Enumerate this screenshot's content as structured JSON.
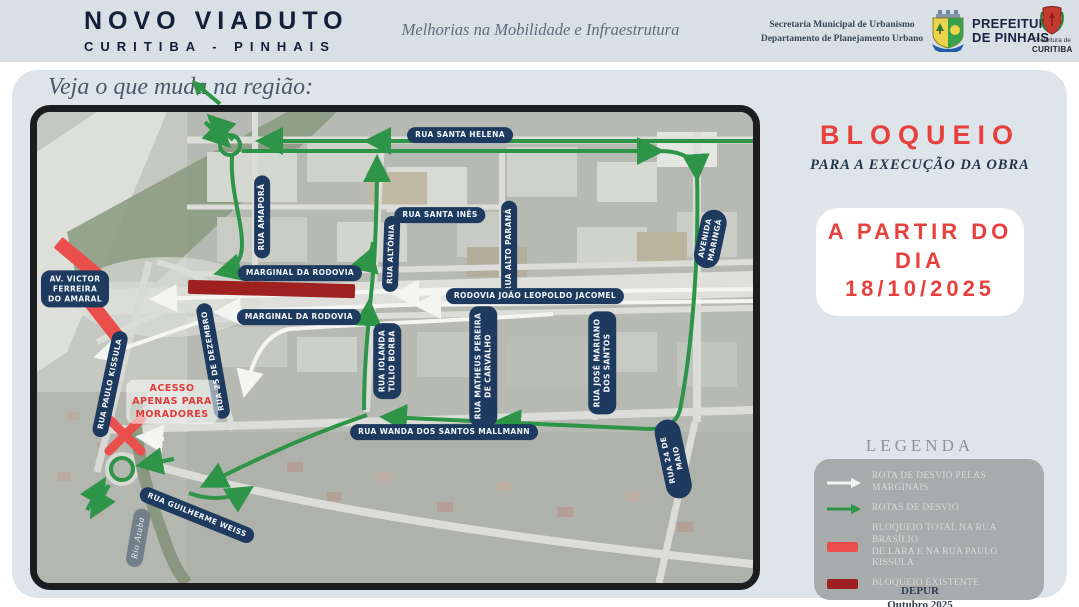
{
  "header": {
    "title_line1": "NOVO VIADUTO",
    "title_line2": "CURITIBA - PINHAIS",
    "tagline": "Melhorias na Mobilidade e Infraestrutura",
    "secretariat_line1": "Secretaria Municipal de Urbanismo",
    "secretariat_line2": "Departamento de Planejamento Urbano",
    "pinhais_logo_label": "PREFEITURA\nDE PINHAIS",
    "curitiba_logo_label_top": "Prefeitura de",
    "curitiba_logo_label_bottom": "CURITIBA"
  },
  "intro_title": "Veja o que muda na região:",
  "map": {
    "labels": [
      {
        "text": "RUA SANTA HELENA"
      },
      {
        "text": "RUA AMAPORÃ"
      },
      {
        "text": "RUA SANTA INÊS"
      },
      {
        "text": "RUA ALTÔNIA"
      },
      {
        "text": "RUA ALTO PARANÁ"
      },
      {
        "text": "AVENIDA MARINGÁ"
      },
      {
        "text": "MARGINAL DA RODOVIA"
      },
      {
        "text": "RODOVIA JOÃO LEOPOLDO JACOMEL"
      },
      {
        "text": "MARGINAL DA RODOVIA"
      },
      {
        "text": "AV. VICTOR\nFERREIRA\nDO AMARAL"
      },
      {
        "text": "RUA PAULO KISSULA"
      },
      {
        "text": "RUA 25 DE DEZEMBRO"
      },
      {
        "text": "RUA IOLANDA\nTÚLIO BORBA"
      },
      {
        "text": "RUA MATHEUS PEREIRA\nDE CARVALHO"
      },
      {
        "text": "RUA JOSÉ MARIANO\nDOS SANTOS"
      },
      {
        "text": "RUA WANDA DOS SANTOS MALLMANN"
      },
      {
        "text": "RUA 24 DE MAIO"
      },
      {
        "text": "RUA GUILHERME WEISS"
      }
    ],
    "river_label": "Rio Atuba",
    "access_note": "ACESSO\nAPENAS PARA\nMORADORES"
  },
  "panel": {
    "headline": "BLOQUEIO",
    "subheadline": "PARA A EXECUÇÃO DA OBRA",
    "date_line1": "A PARTIR DO",
    "date_line2": "DIA",
    "date_line3": "18/10/2025",
    "legend_title": "LEGENDA",
    "legend_items": [
      {
        "icon": "white-arrow",
        "label": "ROTA DE DESVIO PELAS MARGINAIS"
      },
      {
        "icon": "green-arrow",
        "label": "ROTAS DE DESVIO"
      },
      {
        "icon": "red-bar",
        "label": "BLOQUEIO TOTAL NA RUA BRASÍLIO\nDE LARA E NA RUA PAULO KISSULA"
      },
      {
        "icon": "dark-red-bar",
        "label": "BLOQUEIO EXISTENTE"
      }
    ],
    "credit_line1": "DEPUR",
    "credit_line2": "Outubro 2025"
  },
  "colors": {
    "header_bg": "#d8dfe5",
    "panel_bg": "#dee5ea",
    "navy_pill": "#1e3a5e",
    "accent_red": "#e8403d",
    "blockade_total_red": "#ea4f4b",
    "blockade_existing_red": "#9e2020",
    "route_green": "#2e9447",
    "route_white": "#f4f5f2"
  }
}
